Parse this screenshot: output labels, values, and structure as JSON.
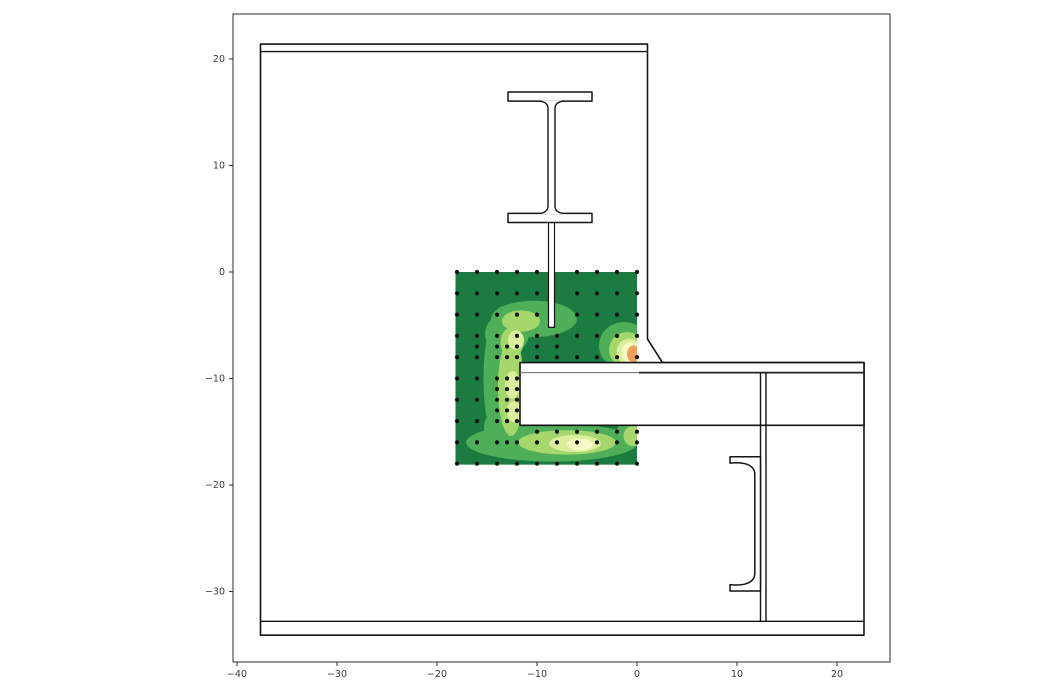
{
  "figure": {
    "width": 1050,
    "height": 700,
    "background": "#ffffff"
  },
  "axes": {
    "box_px": {
      "left": 233,
      "top": 14,
      "right": 890,
      "bottom": 662
    },
    "origin_px": {
      "x": 637,
      "y": 272
    },
    "px_per_unit": {
      "x": 10,
      "y": 10.65
    },
    "spine_color": "#2e2e2e",
    "tick_color": "#2e2e2e",
    "label_color": "#3a3a3a",
    "tick_length": 4,
    "font_size": 9.5,
    "xticks": [
      -40,
      -30,
      -20,
      -10,
      0,
      10,
      20
    ],
    "yticks": [
      20,
      10,
      0,
      -10,
      -20,
      -30
    ]
  },
  "chart_data": {
    "type": "contour",
    "title": "",
    "xlabel": "",
    "ylabel": "",
    "xlim": [
      -40.4,
      25.3
    ],
    "ylim": [
      -36.6,
      24.2
    ],
    "grid": false,
    "legend": "none",
    "description": "Cross-section of a concrete wall / slab joint: steel I-section stub with web plate embedded at top, slab-beam passing through at right, channel shear connector and vertical tie below the slab; filled contour of the measured field over a sensor-point grid on the wall panel.",
    "contour_region": {
      "x_min": -18.15,
      "x_max": 0,
      "y_min": -18.1,
      "y_max": 0
    },
    "levels": [
      {
        "name": "level-0-base",
        "color": "#1b7b40"
      },
      {
        "name": "level-1",
        "color": "#4fae58"
      },
      {
        "name": "level-2",
        "color": "#a5d76d"
      },
      {
        "name": "level-3",
        "color": "#daee9d"
      },
      {
        "name": "level-4",
        "color": "#f7fac4"
      },
      {
        "name": "level-5-hotspot",
        "color": "#f0a05c"
      }
    ],
    "blobs": [
      {
        "level": 1,
        "cx": -10.3,
        "cy": -4.4,
        "rx": 4.3,
        "ry": 1.7
      },
      {
        "level": 1,
        "cx": -13.4,
        "cy": -10.0,
        "rx": 1.95,
        "ry": 6.8
      },
      {
        "level": 1,
        "cx": -13.0,
        "cy": -5.8,
        "rx": 2.2,
        "ry": 1.9
      },
      {
        "level": 1,
        "cx": -13.2,
        "cy": -14.6,
        "rx": 2.1,
        "ry": 2.0
      },
      {
        "level": 1,
        "cx": -8.5,
        "cy": -16.0,
        "rx": 8.6,
        "ry": 1.8
      },
      {
        "level": 1,
        "cx": -0.7,
        "cy": -15.2,
        "rx": 1.4,
        "ry": 1.3
      },
      {
        "level": 1,
        "cx": -1.3,
        "cy": -6.9,
        "rx": 2.5,
        "ry": 2.2
      },
      {
        "level": 2,
        "cx": -11.6,
        "cy": -4.6,
        "rx": 1.9,
        "ry": 1.0
      },
      {
        "level": 2,
        "cx": -12.6,
        "cy": -10.8,
        "rx": 1.3,
        "ry": 4.6
      },
      {
        "level": 2,
        "cx": -12.5,
        "cy": -6.6,
        "rx": 1.15,
        "ry": 1.4
      },
      {
        "level": 2,
        "cx": -7.0,
        "cy": -16.0,
        "rx": 4.9,
        "ry": 1.15
      },
      {
        "level": 2,
        "cx": -1.0,
        "cy": -7.3,
        "rx": 1.8,
        "ry": 1.65
      },
      {
        "level": 2,
        "cx": -0.4,
        "cy": -15.4,
        "rx": 0.95,
        "ry": 0.95
      },
      {
        "level": 3,
        "cx": -12.45,
        "cy": -10.6,
        "rx": 0.75,
        "ry": 1.3
      },
      {
        "level": 3,
        "cx": -12.3,
        "cy": -13.1,
        "rx": 0.7,
        "ry": 1.0
      },
      {
        "level": 3,
        "cx": -12.1,
        "cy": -6.4,
        "rx": 0.8,
        "ry": 0.9
      },
      {
        "level": 3,
        "cx": -6.2,
        "cy": -16.1,
        "rx": 2.6,
        "ry": 0.8
      },
      {
        "level": 3,
        "cx": -0.75,
        "cy": -7.5,
        "rx": 1.3,
        "ry": 1.25
      },
      {
        "level": 4,
        "cx": -5.7,
        "cy": -16.2,
        "rx": 1.3,
        "ry": 0.55
      },
      {
        "level": 4,
        "cx": -0.55,
        "cy": -7.6,
        "rx": 1.0,
        "ry": 1.0
      },
      {
        "level": 5,
        "cx": -0.35,
        "cy": -7.7,
        "rx": 0.65,
        "ry": 0.8
      }
    ],
    "sensor_point_color": "#111111",
    "sensor_point_radius_px": 2.1,
    "sensor_rows": [
      {
        "y": 0,
        "xs": [
          -18,
          -16,
          -14,
          -12,
          -10,
          -6,
          -4,
          -2,
          0
        ]
      },
      {
        "y": -2,
        "xs": [
          -18,
          -16,
          -14,
          -12,
          -10,
          -6,
          -4,
          -2,
          0
        ]
      },
      {
        "y": -4,
        "xs": [
          -18,
          -16,
          -14,
          -12,
          -10,
          -6,
          -4,
          -2,
          0
        ]
      },
      {
        "y": -6,
        "xs": [
          -18,
          -16,
          -14,
          -12,
          -10,
          -8,
          -6,
          -4,
          -2,
          0
        ]
      },
      {
        "y": -7,
        "xs": [
          -16,
          -14,
          -13,
          -12,
          -10,
          -8
        ]
      },
      {
        "y": -8,
        "xs": [
          -18,
          -16,
          -14,
          -13,
          -12,
          -10,
          -8,
          -6,
          -4,
          -2,
          0
        ]
      },
      {
        "y": -10,
        "xs": [
          -18,
          -16,
          -14,
          -13,
          -12
        ]
      },
      {
        "y": -11,
        "xs": [
          -14,
          -13,
          -12
        ]
      },
      {
        "y": -12,
        "xs": [
          -18,
          -16,
          -14,
          -13,
          -12
        ]
      },
      {
        "y": -13,
        "xs": [
          -14,
          -13,
          -12
        ]
      },
      {
        "y": -14,
        "xs": [
          -18,
          -16,
          -14,
          -13,
          -12
        ]
      },
      {
        "y": -15,
        "xs": [
          -10,
          -8,
          -6,
          -4,
          -2,
          0
        ]
      },
      {
        "y": -16,
        "xs": [
          -18,
          -16,
          -14,
          -13,
          -12,
          -10,
          -8,
          -6,
          -4,
          -2,
          0
        ]
      },
      {
        "y": -18,
        "xs": [
          -18,
          -16,
          -14,
          -12,
          -10,
          -8,
          -6,
          -4,
          -2,
          0
        ]
      }
    ],
    "structure": {
      "outline_color": "#141414",
      "fill_color": "#ffffff",
      "wall_polygon": [
        [
          -37.65,
          21.4
        ],
        [
          1.05,
          21.4
        ],
        [
          1.05,
          -6.3
        ],
        [
          2.55,
          -8.5
        ],
        [
          22.7,
          -8.5
        ],
        [
          22.7,
          -34.1
        ],
        [
          -37.65,
          -34.1
        ]
      ],
      "top_plate_line": {
        "y": 20.7,
        "x1": -37.65,
        "x2": 1.05
      },
      "bottom_plate_line": {
        "y": -32.8,
        "x1": -37.65,
        "x2": 22.7
      },
      "beam_rect": {
        "x": -11.7,
        "y_bot": -14.4,
        "w": 34.4,
        "h": 5.9
      },
      "beam_plate_line": {
        "y": -9.45,
        "x1": -11.7,
        "x_dark": 0.2,
        "x2": 22.7,
        "gray": "#6a6a6a"
      },
      "rod_lines": {
        "x": [
          12.35,
          12.9
        ],
        "y1": -9.45,
        "y2": -32.8
      },
      "channel_path": "M 12.35 -17.35 L 9.3 -17.35 L 9.3 -17.95 Q 10.2 -17.85 10.8 -18.0 Q 11.78 -18.25 11.78 -19.0 L 11.78 -28.3 Q 11.78 -29.05 10.8 -29.3 Q 10.2 -29.45 9.3 -29.35 L 9.3 -29.95 L 12.35 -29.95 Z",
      "column_section": {
        "top_flange": {
          "x": -12.9,
          "y_bot": 16.05,
          "w": 8.4,
          "h": 0.85
        },
        "bottom_flange": {
          "x": -12.9,
          "y_bot": 4.65,
          "w": 8.4,
          "h": 0.85
        },
        "web": {
          "x1": -8.9,
          "x2": -8.2,
          "y_top": 16.05,
          "y_bot": 5.5,
          "flare": 0.85,
          "fillet": 0.7
        },
        "stem": {
          "x": -8.85,
          "y_bot": -5.2,
          "w": 0.6,
          "h": 10.0
        }
      }
    }
  }
}
